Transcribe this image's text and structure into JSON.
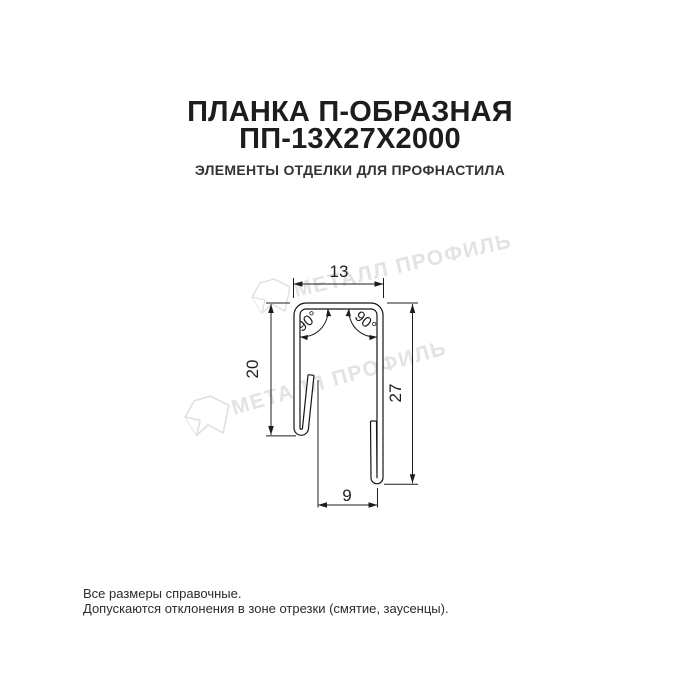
{
  "header": {
    "title_line1": "ПЛАНКА П-ОБРАЗНАЯ",
    "title_line2": "ПП-13Х27Х2000",
    "subtitle": "ЭЛЕМЕНТЫ ОТДЕЛКИ ДЛЯ ПРОФНАСТИЛА"
  },
  "drawing": {
    "type": "sheet-metal profile cross-section",
    "dimensions": {
      "top_width": "13",
      "left_height": "20",
      "right_height": "27",
      "bottom_width": "9",
      "left_angle": "90°",
      "right_angle": "90°"
    },
    "watermark": {
      "text": "МЕТАЛЛ ПРОФИЛЬ"
    }
  },
  "footer": {
    "note_line1": "Все размеры справочные.",
    "note_line2": "Допускаются отклонения в зоне отрезки (смятие, заусенцы)."
  },
  "colors": {
    "background": "#ffffff",
    "title_text": "#1d1d1d",
    "drawing_line": "#151515",
    "watermark": "#e3e3e3"
  }
}
